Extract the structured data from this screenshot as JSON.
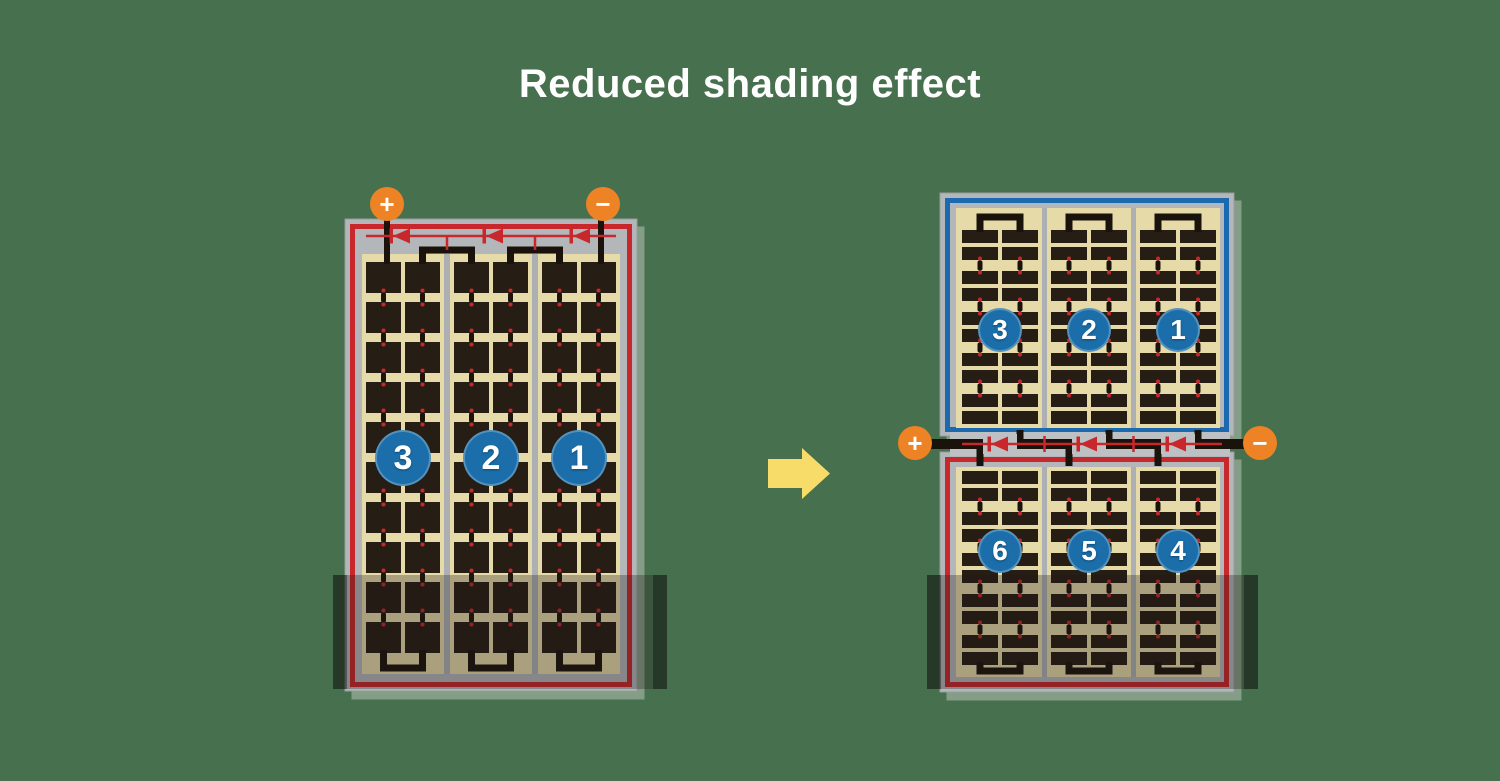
{
  "title": "Reduced shading effect",
  "colors": {
    "background": "#47704E",
    "title_text": "#FFFFFF",
    "panel_frame_gray": "#B3B7BA",
    "panel_frame_edge": "#979CA0",
    "circuit_border_red": "#C8272B",
    "circuit_border_blue": "#1B6AB0",
    "cell_field_tan": "#E6DAA9",
    "cell_dark_brown": "#261D14",
    "column_divider_gray": "#ACB0B3",
    "junction_strip_gray": "#BDC1C4",
    "terminal_orange": "#EE8325",
    "circuit_number_blue": "#1B6EA9",
    "arrow_yellow": "#F8DC6A",
    "trace_black": "#1A130C",
    "shading_overlay": "rgba(32,28,22,0.30)",
    "shading_overlay_edge": "rgba(0,0,0,0.35)"
  },
  "icons": {
    "arrow": "right-block-arrow",
    "diode": "bypass-diode-left",
    "positive_terminal": "plus-terminal-icon",
    "negative_terminal": "minus-terminal-icon"
  },
  "left_panel": {
    "terminals": {
      "positive": "+",
      "negative": "−"
    },
    "circuit_labels": [
      "3",
      "2",
      "1"
    ],
    "shaded_bottom": true
  },
  "right_panel": {
    "terminals": {
      "positive": "+",
      "negative": "−"
    },
    "top_circuit_labels": [
      "3",
      "2",
      "1"
    ],
    "bottom_circuit_labels": [
      "6",
      "5",
      "4"
    ],
    "shaded_bottom": true
  }
}
